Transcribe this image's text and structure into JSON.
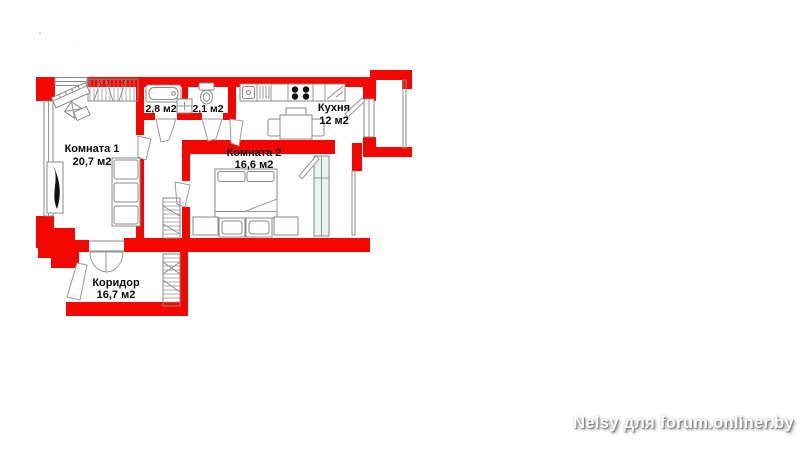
{
  "plan": {
    "rooms": {
      "room1": {
        "name": "Комната 1",
        "area": "20,7 м2"
      },
      "room2": {
        "name": "Комната 2",
        "area": "16,6 м2"
      },
      "kitchen": {
        "name": "Кухня",
        "area": "12 м2"
      },
      "corridor": {
        "name": "Коридор",
        "area": "16,7 м2"
      },
      "bathroom": {
        "area": "2,8 м2"
      },
      "toilet": {
        "area": "2,1 м2"
      }
    },
    "colors": {
      "wall_red": "#f20800",
      "furniture_stroke": "#8a8a8a",
      "label_text": "#0a0a0a",
      "window_glass": "#edf4f0"
    },
    "icons": [
      "window-icon",
      "door-leaf-icon",
      "double-door-icon",
      "bathtub-icon",
      "toilet-icon",
      "washbasin-icon",
      "kitchen-sink-icon",
      "stove-icon",
      "fridge-icon",
      "dining-table-icon",
      "bed-icon",
      "dresser-icon",
      "sofa-icon",
      "wardrobe-icon",
      "piano-icon",
      "stool-icon",
      "plant-icon",
      "balcony-railing-icon"
    ]
  },
  "watermark": {
    "text": "Nelsy для forum.onliner.by",
    "color": "#ffffff"
  }
}
